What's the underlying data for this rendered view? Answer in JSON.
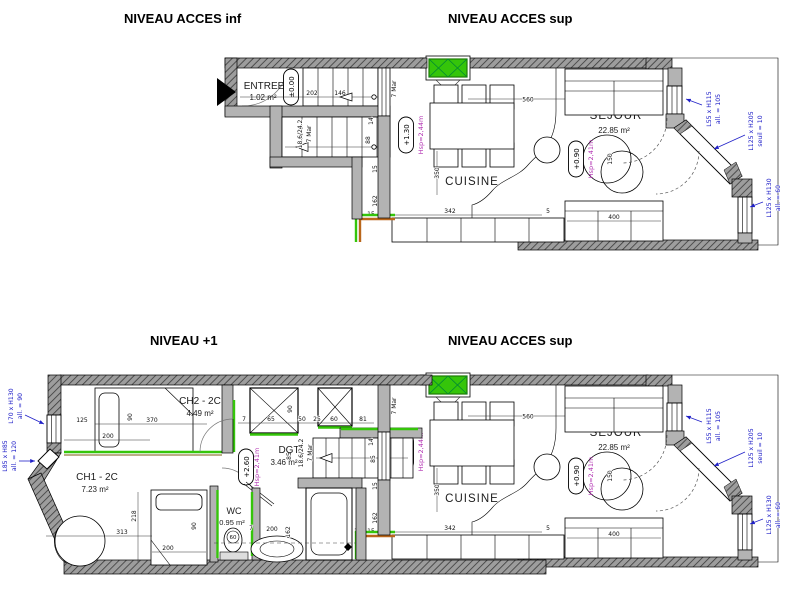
{
  "titles": {
    "top_left": "NIVEAU ACCES inf",
    "top_right": "NIVEAU ACCES sup",
    "bottom_left": "NIVEAU +1",
    "bottom_right": "NIVEAU ACCES sup"
  },
  "rooms": {
    "entree": {
      "label": "ENTREE",
      "area": "1.02 m²"
    },
    "cuisine": {
      "label": "CUISINE"
    },
    "sejour": {
      "label": "SEJOUR",
      "area": "22.85 m²"
    },
    "ch1": {
      "label": "CH1 - 2C",
      "area": "7.23 m²"
    },
    "ch2": {
      "label": "CH2 - 2C",
      "area": "4.49 m²"
    },
    "dgt": {
      "label": "DGT",
      "area": "3.46 m²"
    },
    "wc": {
      "label": "WC",
      "area": "0.95 m²"
    },
    "bains": {
      "label": "BAINS",
      "area": "2.94 m²"
    }
  },
  "levels": {
    "l000": "±0.00",
    "l130": "+1.30",
    "l090": "+0.90",
    "l260": "+2.60"
  },
  "heights": {
    "hsp244": "Hsp=2,44m",
    "hsp241": "Hsp=2,41m"
  },
  "stairs": {
    "ratio": "18.6/24.2",
    "steps": "7 Mar"
  },
  "windows": {
    "w55": {
      "size": "L55 x H115",
      "sill": "all. = 105"
    },
    "w125a": {
      "size": "L125 x H205",
      "sill": "seuil = 10"
    },
    "w125b": {
      "size": "L125 x H130",
      "sill": "all. = 60"
    },
    "w70": {
      "size": "L70 x H130",
      "sill": "all. = 90"
    },
    "w85": {
      "size": "L85 x H85",
      "sill": "all. = 120"
    }
  },
  "dims": {
    "d5": "5",
    "d7": "7",
    "d14": "14",
    "d15": "15",
    "d16": "16",
    "d25": "25",
    "d50": "50",
    "d60": "60",
    "d65": "65",
    "d81": "81",
    "d85": "85",
    "d88": "88",
    "d90": "90",
    "d125": "125",
    "d146": "146",
    "d150": "150",
    "d162": "162",
    "d200": "200",
    "d202": "202",
    "d218": "218",
    "d313": "313",
    "d342": "342",
    "d350": "350",
    "d370": "370",
    "d400": "400",
    "d560": "560"
  },
  "colors": {
    "wall": "#b3b3b3",
    "hatch": "#9d9d9d",
    "green": "#35c50a",
    "orange": "#b9661a",
    "blue": "#2020c8",
    "purple": "#b12fb1"
  }
}
